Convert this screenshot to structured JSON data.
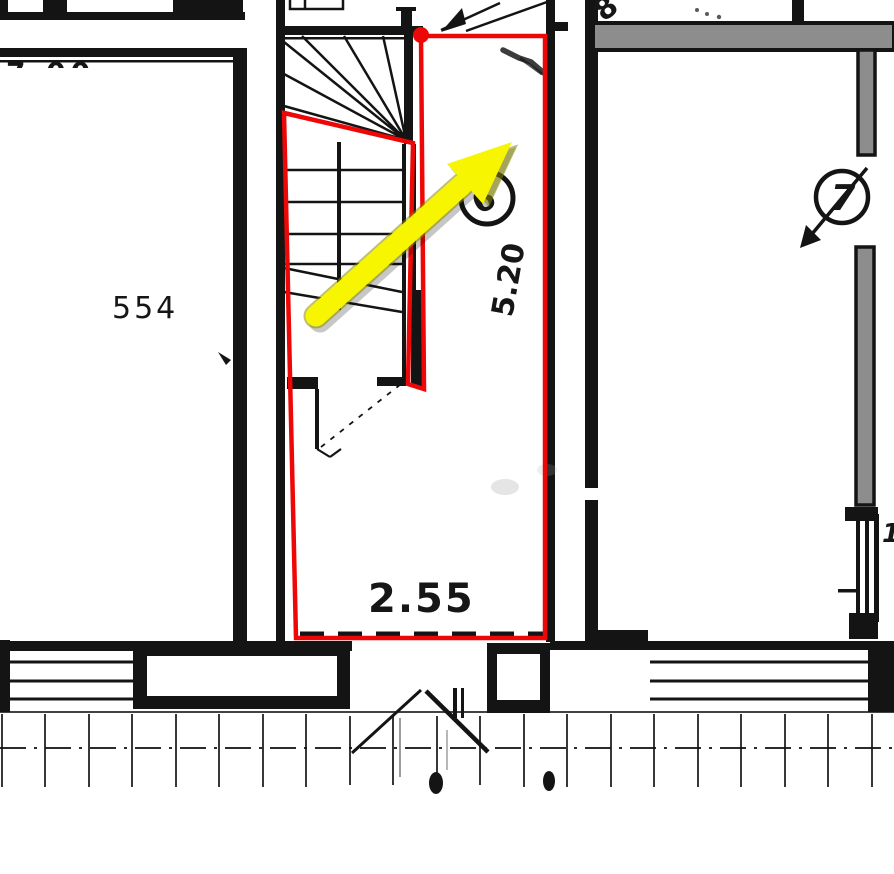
{
  "plan": {
    "room_left_label": "554",
    "bottom_width_dim": "2.55",
    "side_depth_dim": "5.20",
    "circled_stair_unit": "6",
    "circled_right_unit": "7",
    "clipped_top_right_digit": "8",
    "clipped_right_edge_dim": "1.",
    "clipped_top_left_dim": "7.00"
  },
  "annotations": {
    "selection_outline": "red polygon outlining stairwell unit",
    "direction_arrow": "large yellow arrow pointing up-right"
  },
  "colors": {
    "highlight_red": "#ee0707",
    "arrow_yellow": "#f7f500",
    "wall_gray": "#8d8d8d",
    "ink": "#141414",
    "paper": "#ffffff"
  }
}
